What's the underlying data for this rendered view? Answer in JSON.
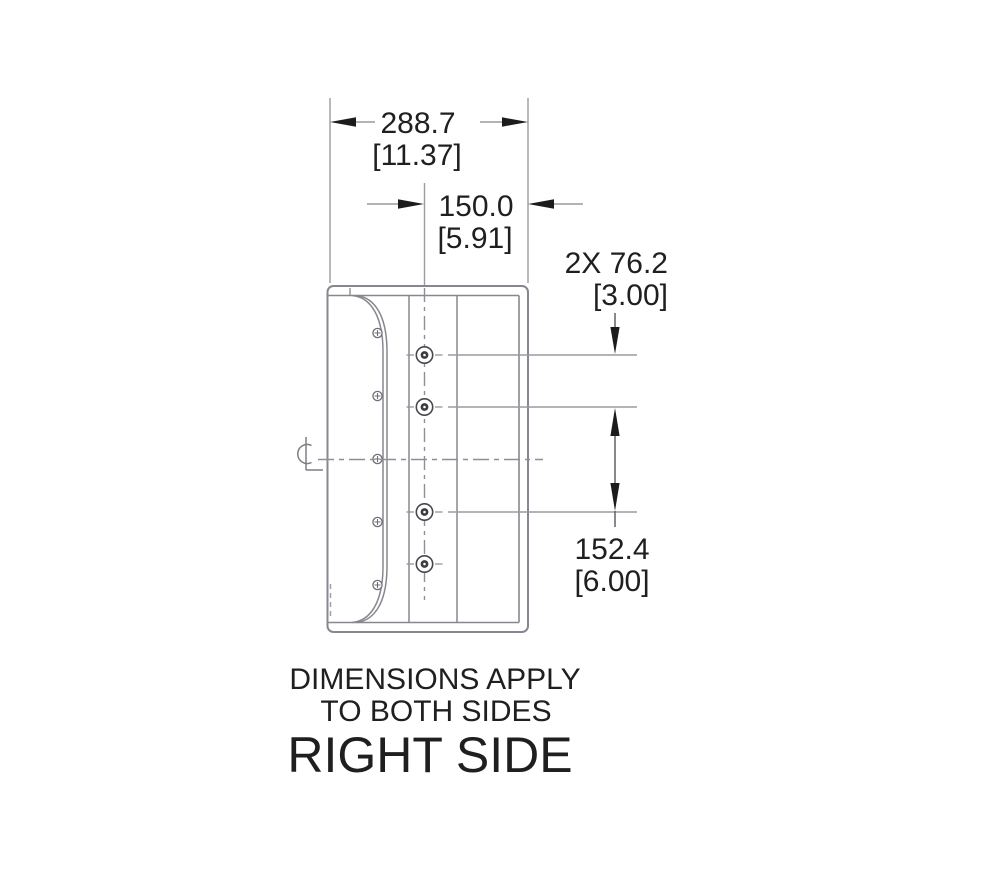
{
  "drawing": {
    "view_label": "RIGHT SIDE",
    "notes": {
      "line1": "DIMENSIONS APPLY",
      "line2": "TO BOTH SIDES"
    },
    "dimensions": {
      "overall_width": {
        "mm": "288.7",
        "inch": "[11.37]"
      },
      "hole_to_back": {
        "mm": "150.0",
        "inch": "[5.91]"
      },
      "hole_pitch": {
        "mm": "2X 76.2",
        "inch": "[3.00]"
      },
      "hole_span": {
        "mm": "152.4",
        "inch": "[6.00]"
      }
    },
    "colors": {
      "body_line": "#87878f",
      "thin_line": "#9b9ba1",
      "ink": "#1c1c1c"
    }
  }
}
